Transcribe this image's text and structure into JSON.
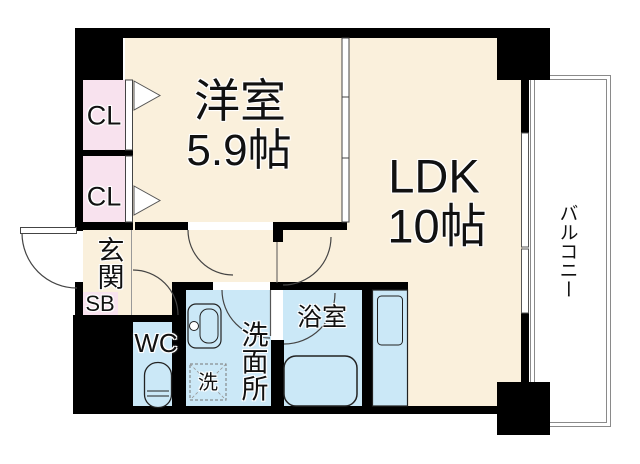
{
  "colors": {
    "floor": "#faf0dc",
    "closet": "#f8e2ee",
    "wet": "#cbe8f7",
    "wall": "#000000",
    "line": "#444444"
  },
  "rooms": {
    "western": {
      "name": "洋室",
      "size": "5.9帖"
    },
    "ldk": {
      "name": "LDK",
      "size": "10帖"
    },
    "closet1": {
      "label": "CL"
    },
    "closet2": {
      "label": "CL"
    },
    "entrance": {
      "name": "玄関"
    },
    "shoebox": {
      "label": "SB"
    },
    "toilet": {
      "label": "WC"
    },
    "washroom": {
      "name": "洗面所"
    },
    "washer": {
      "label": "洗"
    },
    "bathroom": {
      "name": "浴室"
    },
    "balcony": {
      "name": "バルコニー"
    }
  }
}
